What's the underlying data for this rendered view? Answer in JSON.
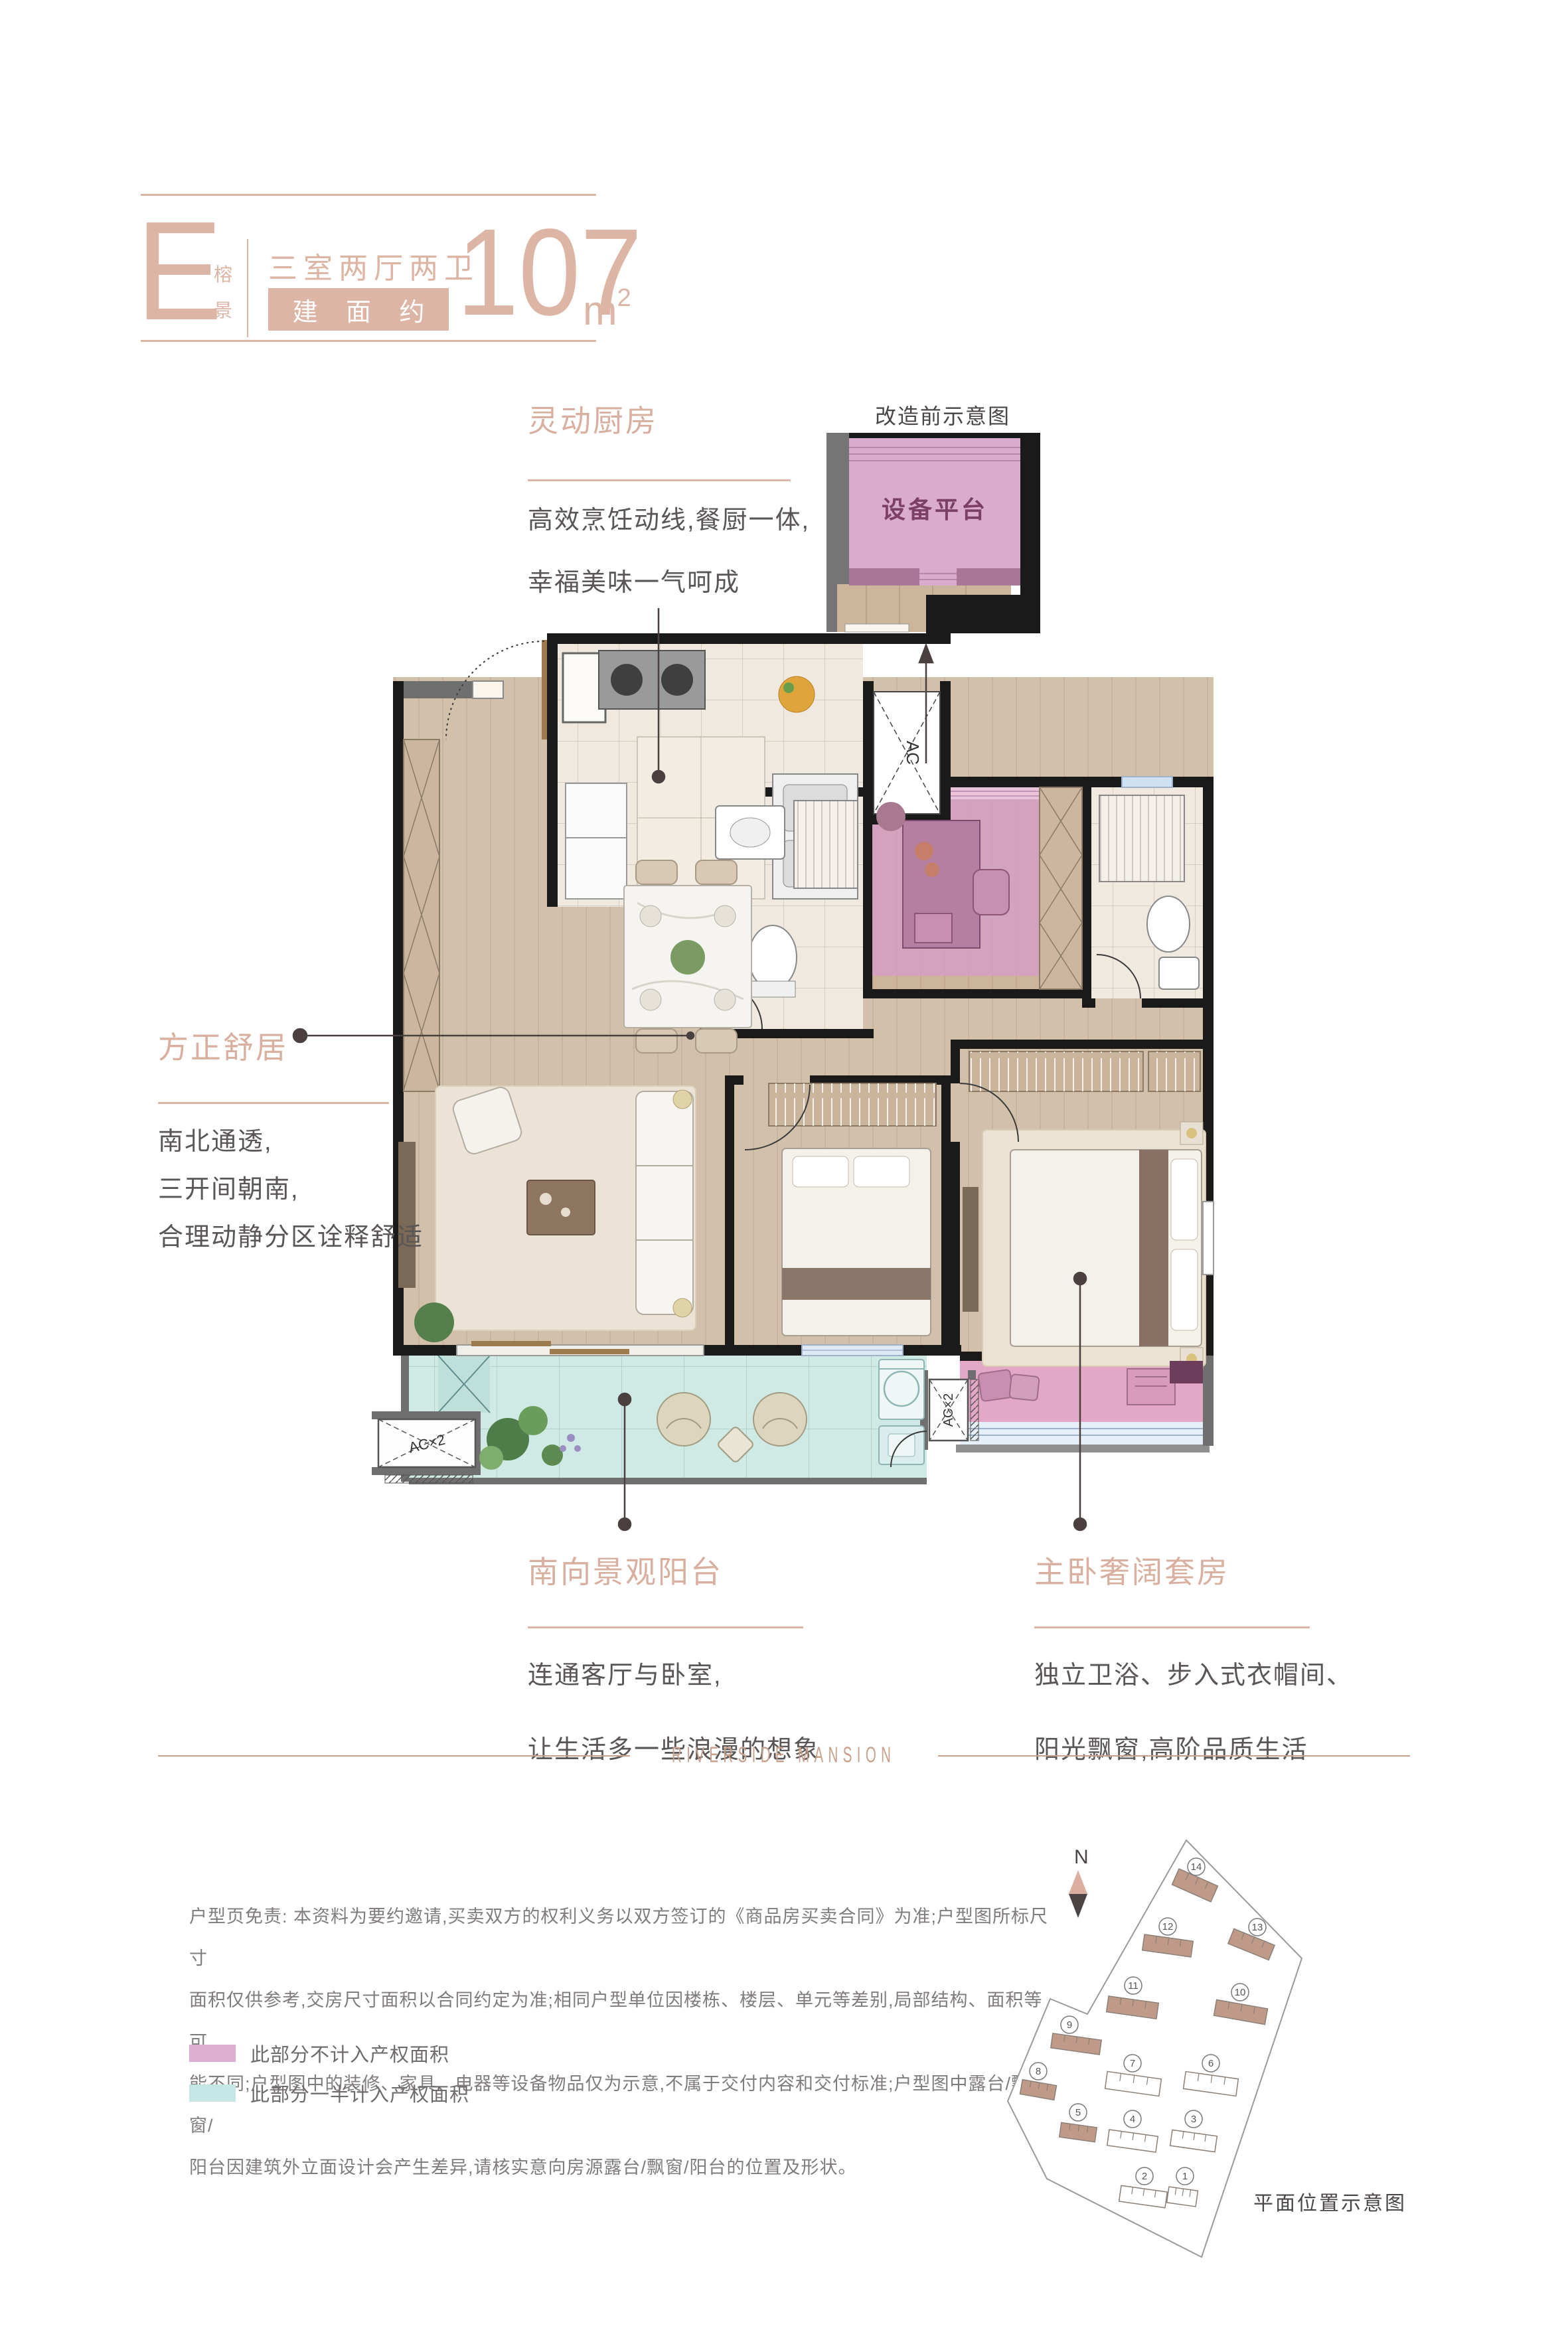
{
  "header": {
    "plan_letter": "E",
    "plan_name_char1": "榕",
    "plan_name_char2": "景",
    "layout_text": "三室两厅两卫",
    "area_label": "建 面 约",
    "area_value": "107",
    "area_unit": "m",
    "area_unit_sup": "2"
  },
  "sections": {
    "kitchen": {
      "title": "灵动厨房",
      "line1": "高效烹饪动线,餐厨一体,",
      "line2": "幸福美味一气呵成"
    },
    "livable": {
      "title": "方正舒居",
      "line1": "南北通透,",
      "line2": "三开间朝南,",
      "line3": "合理动静分区诠释舒适"
    },
    "balcony": {
      "title": "南向景观阳台",
      "line1": "连通客厅与卧室,",
      "line2": "让生活多一些浪漫的想象"
    },
    "master": {
      "title": "主卧奢阔套房",
      "line1": "独立卫浴、步入式衣帽间、",
      "line2": "阳光飘窗,高阶品质生活"
    }
  },
  "before_diagram": {
    "caption": "改造前示意图",
    "room_label": "设备平台"
  },
  "floor_plan": {
    "ac_shaft_label": "AC",
    "ac_left_label": "AC×2",
    "ac_right_label": "AC×2"
  },
  "brand": {
    "divider_text": "RIVERSIDE MANSION"
  },
  "disclaimer": {
    "line1": "户型页免责: 本资料为要约邀请,买卖双方的权利义务以双方签订的《商品房买卖合同》为准;户型图所标尺寸",
    "line2": "面积仅供参考,交房尺寸面积以合同约定为准;相同户型单位因楼栋、楼层、单元等差别,局部结构、面积等可",
    "line3": "能不同;户型图中的装修、家具、电器等设备物品仅为示意,不属于交付内容和交付标准;户型图中露台/飘窗/",
    "line4": "阳台因建筑外立面设计会产生差异,请核实意向房源露台/飘窗/阳台的位置及形状。"
  },
  "legend": {
    "items": [
      {
        "color": "#dcaed2",
        "label": "此部分不计入产权面积"
      },
      {
        "color": "#c6e6e6",
        "label": "此部分一半计入产权面积"
      }
    ]
  },
  "site_plan": {
    "caption": "平面位置示意图",
    "north_label": "N",
    "buildings": [
      {
        "no": "1",
        "highlighted": false
      },
      {
        "no": "2",
        "highlighted": false
      },
      {
        "no": "3",
        "highlighted": false
      },
      {
        "no": "4",
        "highlighted": false
      },
      {
        "no": "5",
        "highlighted": true
      },
      {
        "no": "6",
        "highlighted": false
      },
      {
        "no": "7",
        "highlighted": false
      },
      {
        "no": "8",
        "highlighted": true
      },
      {
        "no": "9",
        "highlighted": true
      },
      {
        "no": "10",
        "highlighted": true
      },
      {
        "no": "11",
        "highlighted": true
      },
      {
        "no": "12",
        "highlighted": true
      },
      {
        "no": "13",
        "highlighted": true
      },
      {
        "no": "14",
        "highlighted": true
      }
    ]
  },
  "colors": {
    "accent": "#dcb5a5",
    "section_title": "#d9afa0",
    "body_text": "#5a5656",
    "wall_black": "#1a1a1a",
    "wall_gray": "#6f6f6f",
    "wood_floor": "#d2c0aa",
    "tile_floor": "#efe9e0",
    "balcony_teal": "#cfe9e4",
    "no_property_pink": "#d4a0c1",
    "bay_window_pink": "#e2a8c5",
    "equipment_platform_pink": "#d9abce",
    "window_blue": "#dfe9f5",
    "site_building_brown": "#c09a89"
  }
}
